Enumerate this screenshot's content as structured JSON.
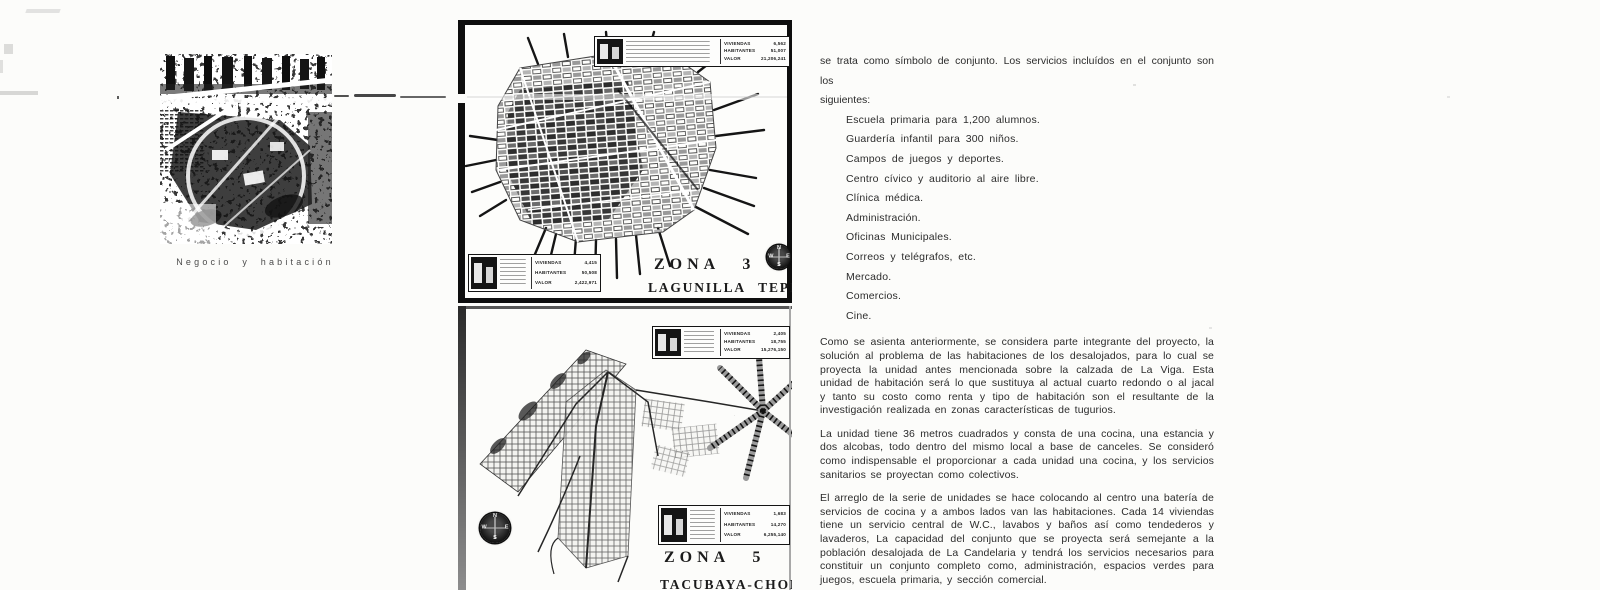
{
  "scan": {
    "caption": "Negocio y habitación"
  },
  "maps": [
    {
      "title": "ZONA 3",
      "subtitle": "LAGUNILLA TEPITO",
      "compass": {
        "n": "N",
        "e": "E",
        "s": "S",
        "w": "W"
      },
      "box_top": {
        "rows": [
          {
            "label": "VIVIENDAS",
            "value": "6,562"
          },
          {
            "label": "HABITANTES",
            "value": "51,007"
          },
          {
            "label": "VALOR",
            "value": "21,206,241"
          }
        ]
      },
      "box_bottom": {
        "rows": [
          {
            "label": "VIVIENDAS",
            "value": "4,415"
          },
          {
            "label": "HABITANTES",
            "value": "50,508"
          },
          {
            "label": "VALOR",
            "value": "2,422,971"
          }
        ]
      }
    },
    {
      "title": "ZONA 5",
      "subtitle": "TACUBAYA-CHORRITO",
      "compass": {
        "n": "N",
        "e": "E",
        "s": "S",
        "w": "W"
      },
      "box_top": {
        "rows": [
          {
            "label": "VIVIENDAS",
            "value": "2,405"
          },
          {
            "label": "HABITANTES",
            "value": "18,755"
          },
          {
            "label": "VALOR",
            "value": "15,276,150"
          }
        ]
      },
      "box_bottom": {
        "rows": [
          {
            "label": "VIVIENDAS",
            "value": "1,683"
          },
          {
            "label": "HABITANTES",
            "value": "14,270"
          },
          {
            "label": "VALOR",
            "value": "6,255,140"
          }
        ]
      }
    }
  ],
  "article": {
    "intro_line1": "se trata como símbolo de conjunto. Los servicios incluídos en el conjunto son los",
    "intro_line2": "siguientes:",
    "services": [
      "Escuela primaria para 1,200 alumnos.",
      "Guardería infantil para 300 niños.",
      "Campos de juegos y deportes.",
      "Centro cívico y auditorio al aire libre.",
      "Clínica médica.",
      "Administración.",
      "Oficinas Municipales.",
      "Correos y telégrafos, etc.",
      "Mercado.",
      "Comercios.",
      "Cine."
    ],
    "paragraphs": [
      "Como se asienta anteriormente, se considera parte integrante del proyecto, la solución al problema de las habitaciones de los desalojados, para lo cual se proyecta la unidad antes mencionada sobre la calzada de La Viga. Esta unidad de habitación será lo que sustituya al actual cuarto redondo o al jacal y tanto su costo como renta y tipo de habitación son el resultante de la investigación realizada en zonas características de tugurios.",
      "La unidad tiene 36 metros cuadrados y consta de una cocina, una estancia y dos alcobas, todo dentro del mismo local a base de canceles. Se consideró como indispensable el proporcionar a cada unidad una cocina, y los servicios sanitarios se proyectan como colectivos.",
      "El arreglo de la serie de unidades se hace colocando al centro una batería de servicios de cocina y a ambos lados van las habitaciones. Cada 14 viviendas tiene un servicio central de W.C., lavabos y baños así como tendederos y lavaderos, La capacidad del conjunto que se proyecta será semejante a la población desalojada de La Candelaria y tendrá los servicios necesarios para constituir un conjunto completo como, administración, espacios verdes para juegos, escuela primaria, y sección comercial."
    ]
  }
}
